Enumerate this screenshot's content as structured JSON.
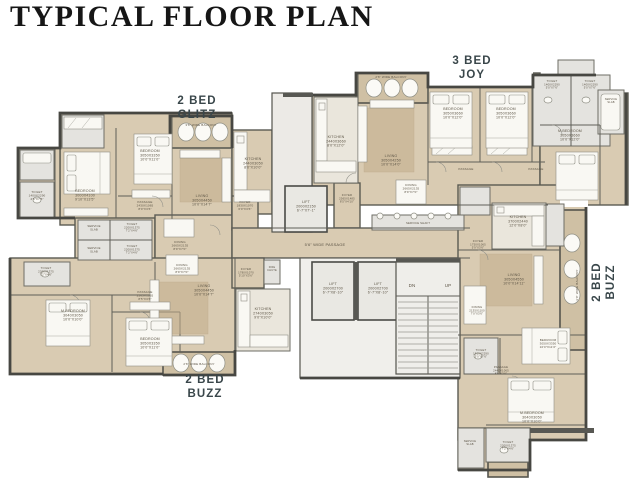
{
  "title": "TYPICAL FLOOR PLAN",
  "colors": {
    "floor": "#d9cbb2",
    "balcony": "#cfc0a4",
    "tile": "#e4e3df",
    "wall": "#585853",
    "room_label": "#5d5546",
    "unit_label": "#39464a"
  },
  "unit_labels": [
    {
      "name": "unit-label-2bed-glitz",
      "lines": [
        "2 BED",
        "GLITZ"
      ],
      "x": 197,
      "y": 104,
      "rotate": 0
    },
    {
      "name": "unit-label-3bed-joy",
      "lines": [
        "3 BED",
        "JOY"
      ],
      "x": 472,
      "y": 64,
      "rotate": 0
    },
    {
      "name": "unit-label-2bed-buzz-bottom",
      "lines": [
        "2 BED",
        "BUZZ"
      ],
      "x": 205,
      "y": 383,
      "rotate": 0
    },
    {
      "name": "unit-label-2bed-buzz-right",
      "lines": [
        "2 BED",
        "BUZZ"
      ],
      "x": 600,
      "y": 282,
      "rotate": -90
    }
  ],
  "room_labels": [
    {
      "name": "balcony-glitz-label",
      "lines": [
        "3'6\" WIDE BALCONY"
      ],
      "x": 201,
      "y": 126,
      "fs": 3
    },
    {
      "name": "living-glitz-label",
      "lines": [
        "LIVING",
        "3050X4450",
        "10'0\"X14'7\""
      ],
      "x": 202,
      "y": 197
    },
    {
      "name": "bedroom-glitz-1-label",
      "lines": [
        "BEDROOM",
        "3050X3350",
        "10'0\"X11'0\""
      ],
      "x": 150,
      "y": 152
    },
    {
      "name": "bedroom-glitz-2-label",
      "lines": [
        "BEDROOM",
        "3000X4100",
        "9'10\"X13'5\""
      ],
      "x": 85,
      "y": 192
    },
    {
      "name": "toilet-glitz-1-label",
      "lines": [
        "TOILET",
        "1400X2290",
        "4'6\"X7'6\""
      ],
      "x": 37,
      "y": 193,
      "fs": 3
    },
    {
      "name": "kitchen-glitz-label",
      "lines": [
        "KITCHEN",
        "2440X3050",
        "8'0\"X10'0\""
      ],
      "x": 253,
      "y": 160
    },
    {
      "name": "foyer-glitz-label",
      "lines": [
        "FOYER",
        "1830X1070",
        "6'0\"X3'6\""
      ],
      "x": 245,
      "y": 203,
      "fs": 3
    },
    {
      "name": "passage-glitz-label",
      "lines": [
        "PASSAGE",
        "2430X1065",
        "8'0\"X3'6\""
      ],
      "x": 145,
      "y": 203,
      "fs": 3
    },
    {
      "name": "dining-glitz-label",
      "lines": [
        "DINING",
        "2665X2135",
        "8'9\"X7'0\""
      ],
      "x": 180,
      "y": 243,
      "fs": 3
    },
    {
      "name": "service-slab-glitz-label",
      "lines": [
        "SERVICE",
        "SLAB"
      ],
      "x": 94,
      "y": 227,
      "fs": 2.8
    },
    {
      "name": "toilet-glitz-2-label",
      "lines": [
        "TOILET",
        "2200X1375",
        "7'2\"X4'6\""
      ],
      "x": 132,
      "y": 225,
      "fs": 2.8
    },
    {
      "name": "service-slab-buzz-b-label",
      "lines": [
        "SERVICE",
        "SLAB"
      ],
      "x": 94,
      "y": 249,
      "fs": 2.8
    },
    {
      "name": "toilet-buzz-b-1-label",
      "lines": [
        "TOILET",
        "2200X1375",
        "7'2\"X4'6\""
      ],
      "x": 132,
      "y": 247,
      "fs": 2.8
    },
    {
      "name": "toilet-buzz-b-2-label",
      "lines": [
        "TOILET",
        "2200X1375",
        "7'2\"X4'6\""
      ],
      "x": 46,
      "y": 269,
      "fs": 2.8
    },
    {
      "name": "mbedroom-buzz-b-label",
      "lines": [
        "M.BEDROOM",
        "3040X3050",
        "10'0\"X10'0\""
      ],
      "x": 73,
      "y": 312
    },
    {
      "name": "bedroom-buzz-b-label",
      "lines": [
        "BEDROOM",
        "3050X3350",
        "10'0\"X11'0\""
      ],
      "x": 150,
      "y": 340
    },
    {
      "name": "passage-buzz-b-label",
      "lines": [
        "PASSAGE",
        "2565X1065",
        "8'5\"X3'6\""
      ],
      "x": 145,
      "y": 293,
      "fs": 3
    },
    {
      "name": "dining-buzz-b-label",
      "lines": [
        "DINING",
        "2665X2135",
        "8'9\"X7'0\""
      ],
      "x": 182,
      "y": 266,
      "fs": 3
    },
    {
      "name": "living-buzz-b-label",
      "lines": [
        "LIVING",
        "3050X4450",
        "10'0\"X14'7\""
      ],
      "x": 204,
      "y": 287
    },
    {
      "name": "foyer-buzz-b-label",
      "lines": [
        "FOYER",
        "1780X1070",
        "5'10\"X3'6\""
      ],
      "x": 246,
      "y": 270,
      "fs": 2.8
    },
    {
      "name": "fire-chute-label",
      "lines": [
        "FIRE",
        "CHUTE"
      ],
      "x": 272,
      "y": 268,
      "fs": 2.6
    },
    {
      "name": "kitchen-buzz-b-label",
      "lines": [
        "KITCHEN",
        "2740X3050",
        "9'0\"X10'0\""
      ],
      "x": 263,
      "y": 310
    },
    {
      "name": "balcony-buzz-b-label",
      "lines": [
        "2'6\" WIDE BALCONY"
      ],
      "x": 199,
      "y": 365,
      "fs": 3
    },
    {
      "name": "balcony-joy-label",
      "lines": [
        "2'6\" WIDE BALCONY"
      ],
      "x": 391,
      "y": 78,
      "fs": 3
    },
    {
      "name": "kitchen-joy-label",
      "lines": [
        "KITCHEN",
        "2440X3660",
        "8'0\"X12'0\""
      ],
      "x": 336,
      "y": 138
    },
    {
      "name": "living-joy-label",
      "lines": [
        "LIVING",
        "3050X4250",
        "10'0\"X14'0\""
      ],
      "x": 391,
      "y": 157
    },
    {
      "name": "bedroom-joy-1-label",
      "lines": [
        "BEDROOM",
        "3050X3660",
        "10'0\"X12'0\""
      ],
      "x": 453,
      "y": 110
    },
    {
      "name": "bedroom-joy-2-label",
      "lines": [
        "BEDROOM",
        "3050X3660",
        "10'0\"X12'0\""
      ],
      "x": 506,
      "y": 110
    },
    {
      "name": "toilet-joy-1-label",
      "lines": [
        "TOILET",
        "1400X2290",
        "5'0\"X7'6\""
      ],
      "x": 552,
      "y": 82,
      "fs": 2.8
    },
    {
      "name": "toilet-joy-2-label",
      "lines": [
        "TOILET",
        "1400X2290",
        "5'0\"X7'6\""
      ],
      "x": 590,
      "y": 82,
      "fs": 2.8
    },
    {
      "name": "service-slab-joy-label",
      "lines": [
        "SERVICE",
        "SLAB"
      ],
      "x": 611,
      "y": 100,
      "fs": 2.6
    },
    {
      "name": "mbedroom-joy-label",
      "lines": [
        "M.BEDROOM",
        "3050X3660",
        "10'0\"X12'0\""
      ],
      "x": 570,
      "y": 132
    },
    {
      "name": "passage-joy-1-label",
      "lines": [
        "PASSAGE"
      ],
      "x": 466,
      "y": 170,
      "fs": 3
    },
    {
      "name": "passage-joy-2-label",
      "lines": [
        "PASSAGE"
      ],
      "x": 536,
      "y": 170,
      "fs": 3
    },
    {
      "name": "dining-joy-label",
      "lines": [
        "DINING",
        "2665X2135",
        "8'9\"X7'0\""
      ],
      "x": 411,
      "y": 186,
      "fs": 3
    },
    {
      "name": "foyer-joy-label",
      "lines": [
        "FOYER",
        "2565X1485",
        "8'5\"X4'10\""
      ],
      "x": 347,
      "y": 196,
      "fs": 2.8
    },
    {
      "name": "service-shaft-label",
      "lines": [
        "SERVICE SHAFT"
      ],
      "x": 418,
      "y": 224,
      "fs": 2.8
    },
    {
      "name": "passage-main-label",
      "lines": [
        "5'6\" WIDE PASSAGE"
      ],
      "x": 325,
      "y": 246,
      "fs": 4
    },
    {
      "name": "lift-1-label",
      "lines": [
        "LIFT",
        "2000X2150",
        "6'-7\"X7'-1\""
      ],
      "x": 306,
      "y": 203
    },
    {
      "name": "lift-2-label",
      "lines": [
        "LIFT",
        "2000X2700",
        "6'-7\"X8'-10\""
      ],
      "x": 333,
      "y": 285
    },
    {
      "name": "lift-3-label",
      "lines": [
        "LIFT",
        "2000X2700",
        "6'-7\"X8'-10\""
      ],
      "x": 378,
      "y": 285
    },
    {
      "name": "stairs-down-label",
      "lines": [
        "DN"
      ],
      "x": 412,
      "y": 287,
      "fs": 4.5
    },
    {
      "name": "stairs-up-label",
      "lines": [
        "UP"
      ],
      "x": 448,
      "y": 287,
      "fs": 4.5
    },
    {
      "name": "kitchen-buzz-r-label",
      "lines": [
        "KITCHEN",
        "3700X2440",
        "12'0\"X8'0\""
      ],
      "x": 518,
      "y": 218
    },
    {
      "name": "foyer-buzz-r-label",
      "lines": [
        "FOYER",
        "1750X1065",
        "5'9\"X3'6\""
      ],
      "x": 478,
      "y": 242,
      "fs": 2.8
    },
    {
      "name": "living-buzz-r-label",
      "lines": [
        "LIVING",
        "3050X4550",
        "10'0\"X14'11\""
      ],
      "x": 514,
      "y": 276
    },
    {
      "name": "dining-buzz-r-label",
      "lines": [
        "DINING",
        "2135X1100",
        "7'0\"X3'6\""
      ],
      "x": 477,
      "y": 308,
      "fs": 2.8
    },
    {
      "name": "balcony-buzz-r-label",
      "lines": [
        "3'0\" WIDE BALCONY"
      ],
      "x": 578,
      "y": 285,
      "fs": 3,
      "rotate": -90
    },
    {
      "name": "toilet-buzz-r-1-label",
      "lines": [
        "TOILET",
        "1510X2290",
        "5'0\"X7'6\""
      ],
      "x": 481,
      "y": 351,
      "fs": 2.8
    },
    {
      "name": "bedroom-buzz-r-label",
      "lines": [
        "BEDROOM",
        "3050X3350",
        "10'0\"X11'0\""
      ],
      "x": 548,
      "y": 341,
      "fs": 3
    },
    {
      "name": "passage-buzz-r-label",
      "lines": [
        "PASSAGE",
        "2440X1065",
        "8'0\"X3'6\""
      ],
      "x": 501,
      "y": 368,
      "fs": 2.8
    },
    {
      "name": "mbedroom-buzz-r-label",
      "lines": [
        "M.BEDROOM",
        "3040X3050",
        "10'0\"X10'0\""
      ],
      "x": 532,
      "y": 414
    },
    {
      "name": "toilet-buzz-r-2-label",
      "lines": [
        "TOILET",
        "2200X1375",
        "7'2\"X4'6\""
      ],
      "x": 508,
      "y": 443,
      "fs": 2.8
    },
    {
      "name": "service-slab-buzz-r-label",
      "lines": [
        "SERVICE",
        "SLAB"
      ],
      "x": 470,
      "y": 442,
      "fs": 2.6
    }
  ]
}
